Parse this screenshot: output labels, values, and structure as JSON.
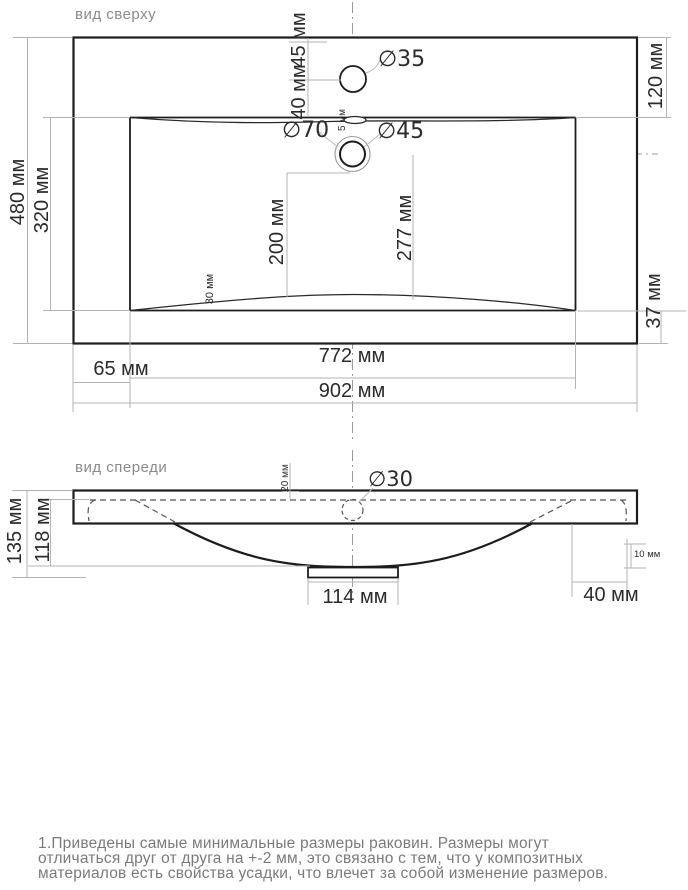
{
  "top_view": {
    "label": "вид сверху",
    "dims": {
      "faucet_diameter": "∅35",
      "faucet_offset_top": "45 мм",
      "faucet_to_basin": "40 мм",
      "overflow_height": "5 мм",
      "drain_outer_diameter": "∅70",
      "drain_inner_diameter": "∅45",
      "right_top_offset": "120 мм",
      "outer_depth": "480 мм",
      "basin_depth": "320 мм",
      "drain_to_front": "200 мм",
      "center_to_front": "277 мм",
      "front_wall": "30 мм",
      "bottom_offset": "37 мм",
      "basin_width": "772 мм",
      "side_offset": "65 мм",
      "outer_width": "902 мм"
    }
  },
  "front_view": {
    "label": "вид спереди",
    "dims": {
      "drain_diameter": "∅30",
      "rim_depth": "20 мм",
      "total_height": "135 мм",
      "basin_height": "118 мм",
      "flange_width": "114 мм",
      "edge_thickness": "10 мм",
      "side_margin": "40 мм"
    }
  },
  "note": {
    "line1": "1.Приведены самые минимальные размеры раковин. Размеры могут",
    "line2": "отличаться друг от друга на +-2 мм, это связано с тем, что у композитных",
    "line3": "материалов есть свойства усадки, что влечет за собой изменение размеров."
  }
}
